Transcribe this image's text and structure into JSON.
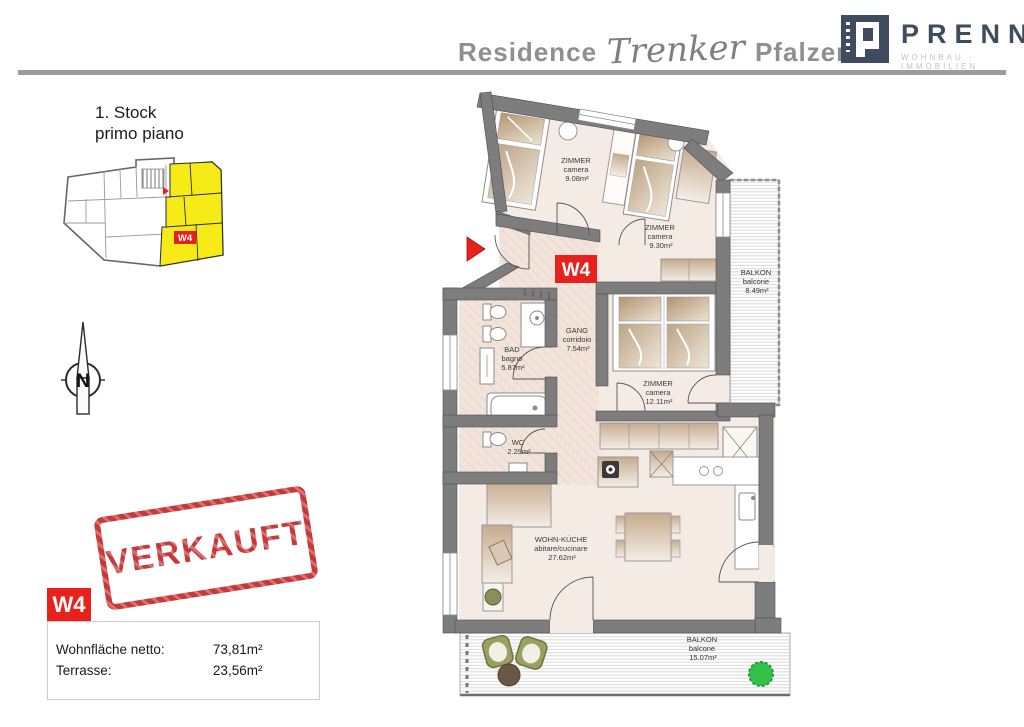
{
  "header": {
    "title": {
      "part1": "Residence",
      "part2": "Trenker",
      "part3": "Pfalzen"
    },
    "brand": {
      "name": "PRENN",
      "tagline": "WOHNBAU · IMMOBILIEN"
    }
  },
  "floor_label": {
    "de": "1. Stock",
    "it": "primo piano"
  },
  "overview": {
    "unit_tag": "W4"
  },
  "compass": {
    "north": "N"
  },
  "stamp": {
    "text": "VERKAUFT"
  },
  "unit_panel": {
    "tag": "W4",
    "rows": [
      {
        "label": "Wohnfläche netto:",
        "value": "73,81m²"
      },
      {
        "label": "Terrasse:",
        "value": "23,56m²"
      }
    ]
  },
  "plan": {
    "unit_tag": "W4",
    "rooms": [
      {
        "id": "zimmer1",
        "de": "ZIMMER",
        "it": "camera",
        "area": "9.08m²"
      },
      {
        "id": "zimmer2",
        "de": "ZIMMER",
        "it": "camera",
        "area": "9.30m²"
      },
      {
        "id": "balkon1",
        "de": "BALKON",
        "it": "balcone",
        "area": "8.49m²"
      },
      {
        "id": "gang",
        "de": "GANG",
        "it": "corridoio",
        "area": "7.54m²"
      },
      {
        "id": "bad",
        "de": "BAD",
        "it": "bagno",
        "area": "5.87m²"
      },
      {
        "id": "zimmer3",
        "de": "ZIMMER",
        "it": "camera",
        "area": "12.11m²"
      },
      {
        "id": "wc",
        "de": "WC",
        "it": "",
        "area": "2.29m²"
      },
      {
        "id": "wohnkueche",
        "de": "WOHN-KÜCHE",
        "it": "abitare/cucinare",
        "area": "27.62m²"
      },
      {
        "id": "balkon2",
        "de": "BALKON",
        "it": "balcone",
        "area": "15.07m²"
      }
    ]
  },
  "colors": {
    "accent_red": "#e8211d",
    "highlight_yellow": "#f6eb16",
    "brand_navy": "#3f4b5f",
    "wall_gray": "#7d7d7d",
    "stamp_red": "#c32b2b",
    "floor_fill": "#f5ebe5"
  }
}
